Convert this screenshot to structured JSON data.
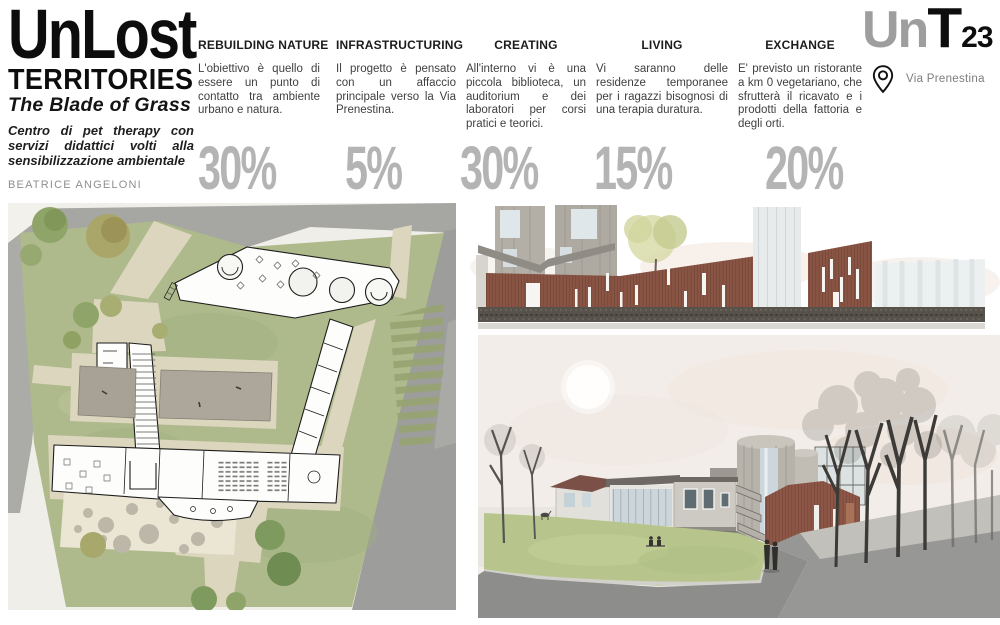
{
  "poster": {
    "title_main": "UnLost",
    "title_sub": "TERRITORIES",
    "tagline": "The Blade of Grass",
    "description": "Centro di pet therapy con servizi didattici volti alla sensibilizzazione ambientale",
    "author": "BEATRICE ANGELONI"
  },
  "columns": [
    {
      "heading": "REBUILDING NATURE",
      "body": "L'obiettivo è quello di essere un punto di contatto tra ambiente urbano e natura.",
      "percent": "30%"
    },
    {
      "heading": "INFRASTRUCTURING",
      "body": "Il progetto è pensato con un affaccio principale verso la Via Prenestina.",
      "percent": "5%"
    },
    {
      "heading": "CREATING",
      "body": "All'interno vi è una piccola biblioteca, un auditorium e dei laboratori per corsi pratici e teorici.",
      "percent": "30%"
    },
    {
      "heading": "LIVING",
      "body": "Vi saranno delle residenze temporanee per i ragazzi bisognosi di una terapia duratura.",
      "percent": "15%"
    },
    {
      "heading": "EXCHANGE",
      "body": "E' previsto un ristorante a km 0 vegetariano, che sfrutterà il ricavato e i prodotti della fattoria e degli orti.",
      "percent": "20%"
    }
  ],
  "logo": {
    "prefix": "Un",
    "letter": "T",
    "number": "23",
    "address": "Via Prenestina",
    "pin_icon": "location-pin-icon"
  },
  "colors": {
    "percent_gray": "#b4b4b4",
    "logo_gray": "#9e9e9e",
    "heading_black": "#1c1c1c",
    "body_text": "#3f3f3f",
    "corten_rust": "#8a5444",
    "plan_grass": "#aeba8c",
    "render_lawn": "#b7c58c",
    "path_beige": "#ddd6bf",
    "road_gray": "#9d9d9b"
  }
}
